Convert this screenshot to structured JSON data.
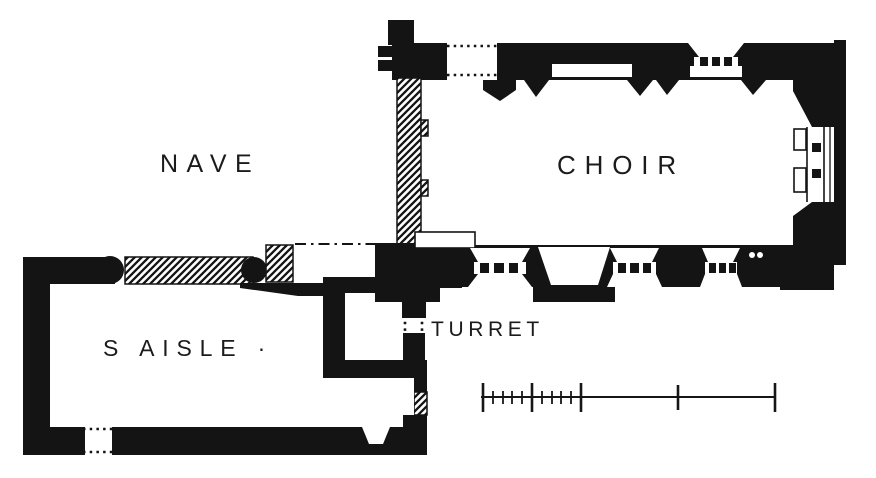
{
  "figure": {
    "kind": "church floor plan",
    "ink_color": "#141414",
    "paper_color": "#ffffff",
    "labels": {
      "nave": "NAVE",
      "choir": "CHOIR",
      "south_aisle": "S AISLE ·",
      "turret": "TURRET"
    },
    "scale_bar": {
      "major_tick_count": 5,
      "subdivided_left_divisions": 2,
      "minor_ticks_per_division": 4
    }
  }
}
